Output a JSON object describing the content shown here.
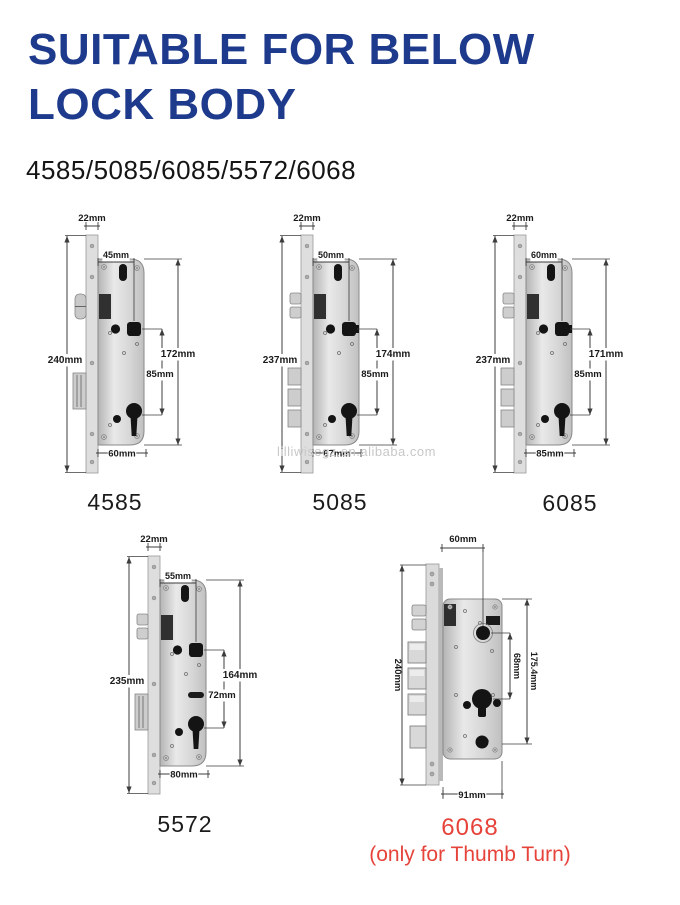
{
  "header": {
    "title_line1": "SUITABLE FOR BELOW",
    "title_line2": "LOCK BODY",
    "models": "4585/5085/6085/5572/6068"
  },
  "watermark": "lilliwisegz.en.alibaba.com",
  "colors": {
    "title_blue": "#1e3a8c",
    "accent_red": "#e6443b",
    "dim_line": "#3c3c3c",
    "label_dark": "#1b1b1b",
    "metal_light": "#e9e9e9",
    "metal_dark": "#b4b4b4",
    "hole_black": "#141414",
    "watermark_gray": "#c8c8c8"
  },
  "locks": [
    {
      "id": "4585",
      "label": "4585",
      "view": "front",
      "latch": "roller",
      "deadbolts": 1,
      "dims": {
        "faceplate_width": "22mm",
        "backset": "45mm",
        "faceplate_height": "240mm",
        "body_height": "172mm",
        "center_distance": "85mm",
        "body_width": "60mm"
      }
    },
    {
      "id": "5085",
      "label": "5085",
      "view": "front",
      "latch": "split",
      "deadbolts": 3,
      "dims": {
        "faceplate_width": "22mm",
        "backset": "50mm",
        "faceplate_height": "237mm",
        "body_height": "174mm",
        "center_distance": "85mm",
        "body_width": "67mm"
      }
    },
    {
      "id": "6085",
      "label": "6085",
      "view": "front",
      "latch": "split",
      "deadbolts": 3,
      "dims": {
        "faceplate_width": "22mm",
        "backset": "60mm",
        "faceplate_height": "237mm",
        "body_height": "171mm",
        "center_distance": "85mm",
        "body_width": "85mm"
      }
    },
    {
      "id": "5572",
      "label": "5572",
      "view": "front",
      "latch": "split",
      "deadbolts": 1,
      "dims": {
        "faceplate_width": "22mm",
        "backset": "55mm",
        "faceplate_height": "235mm",
        "body_height": "164mm",
        "center_distance": "72mm",
        "body_width": "80mm"
      }
    },
    {
      "id": "6068",
      "label": "6068",
      "sub_label": "(only for Thumb Turn)",
      "view": "angled",
      "latch": "split",
      "deadbolts": 4,
      "dims": {
        "backset": "60mm",
        "faceplate_height": "240mm",
        "center_distance": "68mm",
        "body_height": "175.4mm",
        "body_width": "91mm"
      }
    }
  ]
}
